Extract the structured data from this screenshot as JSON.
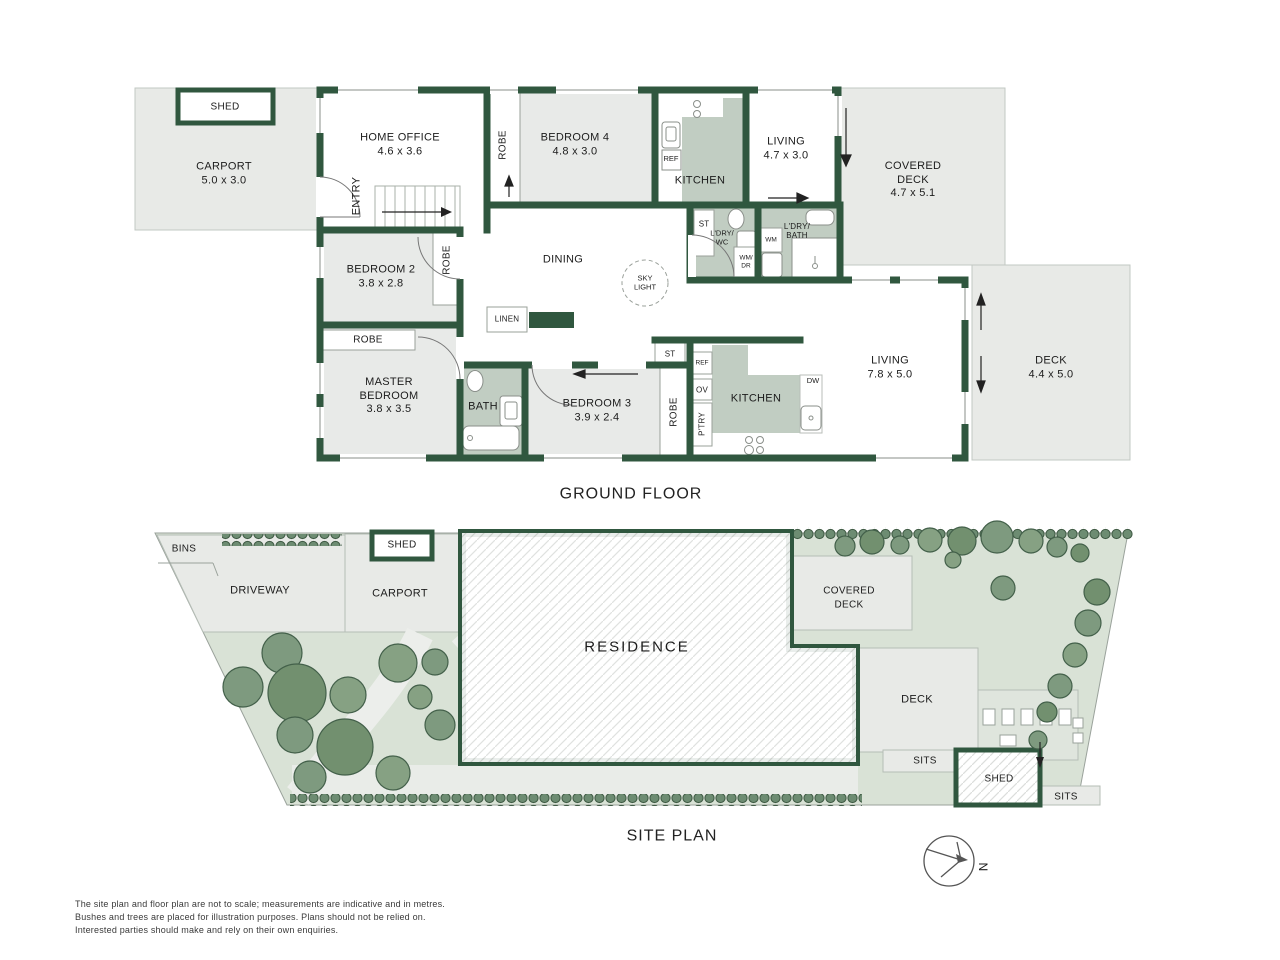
{
  "titles": {
    "ground_floor": "GROUND FLOOR",
    "site_plan": "SITE PLAN",
    "north": "N"
  },
  "colors": {
    "wall_green": "#30573f",
    "room_grey": "#e8eae8",
    "wet_area_sage": "#c1cdc2",
    "site_lawn": "#d9e2d6",
    "hardscape_grey": "#e8eae7",
    "tree_green": "#7e9a7f",
    "text": "#1c1c1c"
  },
  "ground_floor": {
    "shed": {
      "label": "SHED"
    },
    "carport": {
      "label": "CARPORT",
      "dims": "5.0 x 3.0"
    },
    "home_office": {
      "label": "HOME OFFICE",
      "dims": "4.6 x 3.6"
    },
    "entry": {
      "label": "ENTRY"
    },
    "robe_bed4": {
      "label": "ROBE"
    },
    "bedroom4": {
      "label": "BEDROOM 4",
      "dims": "4.8 x 3.0"
    },
    "kitchen_top": {
      "label": "KITCHEN"
    },
    "ref_top": {
      "label": "REF"
    },
    "living_top": {
      "label": "LIVING",
      "dims": "4.7 x 3.0"
    },
    "covered_deck": {
      "line1": "COVERED",
      "line2": "DECK",
      "dims": "4.7 x 5.1"
    },
    "bedroom2": {
      "label": "BEDROOM 2",
      "dims": "3.8 x 2.8"
    },
    "robe_bed2": {
      "label": "ROBE"
    },
    "dining": {
      "label": "DINING"
    },
    "skylight": {
      "line1": "SKY",
      "line2": "LIGHT"
    },
    "st_laundry": {
      "label": "ST"
    },
    "ldry_wc": {
      "line1": "L'DRY/",
      "line2": "WC"
    },
    "wm_dr": {
      "line1": "WM/",
      "line2": "DR"
    },
    "wm": {
      "label": "WM"
    },
    "ldry_bath": {
      "line1": "L'DRY/",
      "line2": "BATH"
    },
    "linen": {
      "label": "LINEN"
    },
    "robe_master": {
      "label": "ROBE"
    },
    "master_bedroom": {
      "line1": "MASTER",
      "line2": "BEDROOM",
      "dims": "3.8 x 3.5"
    },
    "bath": {
      "label": "BATH"
    },
    "bedroom3": {
      "label": "BEDROOM 3",
      "dims": "3.9 x 2.4"
    },
    "robe_bed3": {
      "label": "ROBE"
    },
    "st_kitchen": {
      "label": "ST"
    },
    "ref_bottom": {
      "label": "REF"
    },
    "ov": {
      "label": "OV"
    },
    "ptry": {
      "label": "P'TRY"
    },
    "kitchen_bottom": {
      "label": "KITCHEN"
    },
    "dw": {
      "label": "DW"
    },
    "living_main": {
      "label": "LIVING",
      "dims": "7.8 x 5.0"
    },
    "deck": {
      "label": "DECK",
      "dims": "4.4 x 5.0"
    }
  },
  "site_plan": {
    "bins": {
      "label": "BINS"
    },
    "driveway": {
      "label": "DRIVEWAY"
    },
    "shed_front": {
      "label": "SHED"
    },
    "carport": {
      "label": "CARPORT"
    },
    "residence": {
      "label": "RESIDENCE"
    },
    "covered_deck": {
      "line1": "COVERED",
      "line2": "DECK"
    },
    "deck": {
      "label": "DECK"
    },
    "sits_left": {
      "label": "SITS"
    },
    "shed_rear": {
      "label": "SHED"
    },
    "sits_right": {
      "label": "SITS"
    }
  },
  "disclaimer": {
    "line1": "The site plan and floor plan are not to scale; measurements are indicative and in metres.",
    "line2": "Bushes and trees are placed for illustration purposes. Plans should not be relied on.",
    "line3": "Interested parties should make and rely on their own enquiries."
  }
}
